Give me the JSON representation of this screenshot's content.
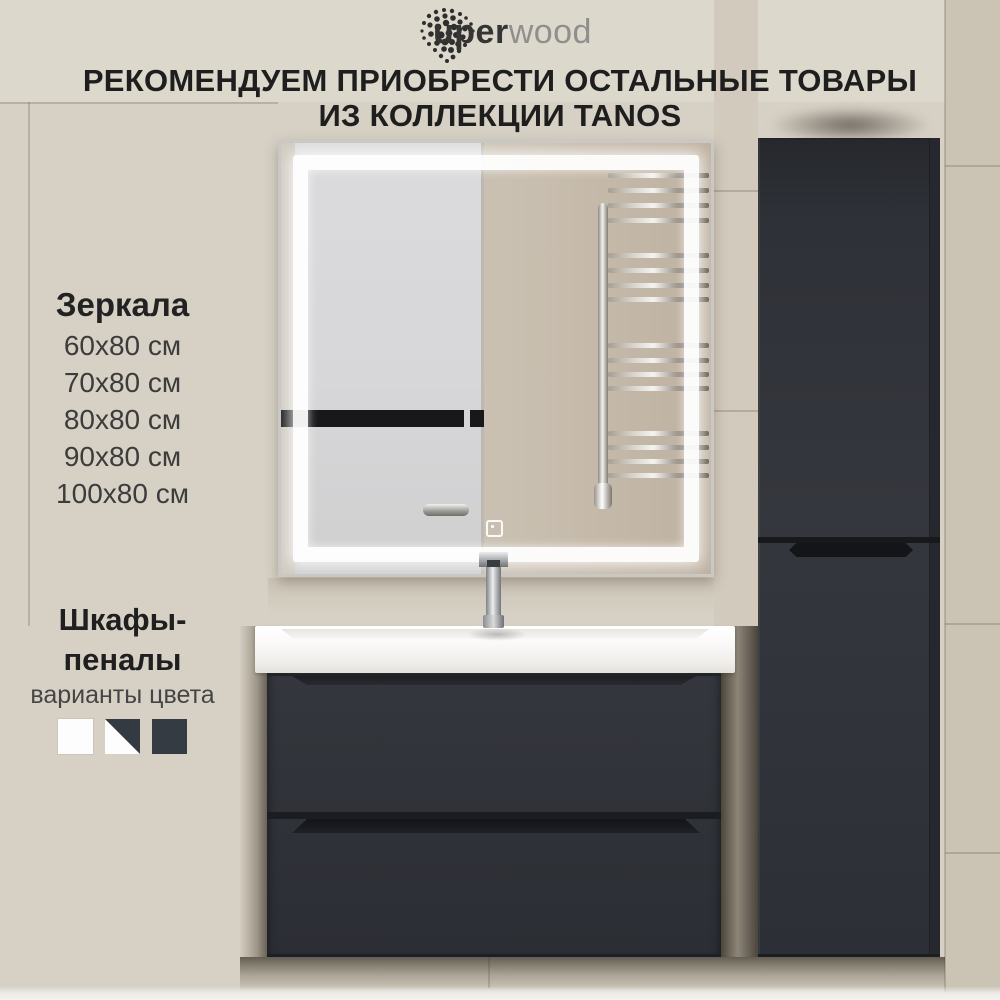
{
  "brand": {
    "logo_text_bold": "uper",
    "logo_text_light": "wood"
  },
  "heading": {
    "line1": "РЕКОМЕНДУЕМ ПРИОБРЕСТИ ОСТАЛЬНЫЕ ТОВАРЫ",
    "line2": "ИЗ КОЛЛЕКЦИИ TANOS"
  },
  "mirrors_section": {
    "title": "Зеркала",
    "sizes": [
      "60x80 см",
      "70x80 см",
      "80x80 см",
      "90x80 см",
      "100x80 см"
    ]
  },
  "cabinets_section": {
    "title": "Шкафы-пеналы",
    "subtitle": "варианты цвета",
    "swatches": [
      {
        "name": "white",
        "hex": "#fdfdfd"
      },
      {
        "name": "white-dark-split",
        "hex_top": "#343a42",
        "hex_bottom": "#fdfdfd"
      },
      {
        "name": "dark-graphite",
        "hex": "#353b43"
      }
    ]
  },
  "scene": {
    "wall_hex": "#d7d1c5",
    "furniture_hex": "#2f3238",
    "sink_hex": "#f5f4f2",
    "led_hex": "#ffffff",
    "objects": [
      "led-mirror",
      "chrome-faucet",
      "washbasin-vanity-two-drawers",
      "tall-side-cabinet",
      "towel-rail-reflection"
    ]
  }
}
